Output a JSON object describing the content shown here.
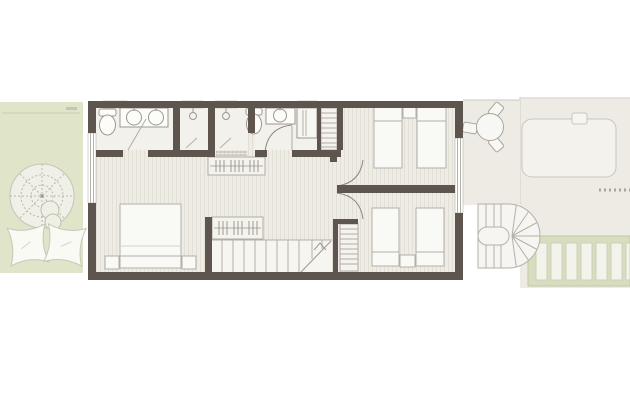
{
  "scene": {
    "type": "architectural-floor-plan",
    "description": "top-view plan of a narrow townhouse upper floor with garden at left, bedrooms and bathrooms inside, terrace, day-bed pad, pergola and exterior curved stair at right",
    "canvas_px": {
      "width": 630,
      "height": 401
    },
    "background": "#ffffff",
    "visible_text": []
  },
  "palette": {
    "wall": "#5e564e",
    "floor_base": "#eeece5",
    "floor_stripe": "#e2dfd7",
    "wet_room_floor": "#f2f1eb",
    "stair_floor": "#f6f5f0",
    "fixture_fill": "#fcfcf9",
    "outline_strong": "#9d988f",
    "outline_light": "#b5b1a8",
    "garden_green": "#e0e4c9",
    "garden_line": "#c9ceb2",
    "terrace_beige": "#edebe4",
    "pool_pad": "#f3f2ed",
    "pergola_green": "#d8ddc0",
    "pergola_slat": "#f3f3ec",
    "dash_marker": "#a8a49b"
  },
  "regions": {
    "garden": {
      "side": "left",
      "items": [
        "parasol",
        "bean-bag-cushion",
        "bean-bag-cushion",
        "side-table",
        "hedge-line"
      ]
    },
    "dwelling": {
      "rooms": [
        {
          "name": "bathroom-1",
          "fixtures": [
            "toilet",
            "double-basin-vanity"
          ]
        },
        {
          "name": "shower-stall-1",
          "fixtures": [
            "shower-head"
          ]
        },
        {
          "name": "shower-stall-2",
          "fixtures": [
            "shower-head"
          ]
        },
        {
          "name": "bathroom-2",
          "fixtures": [
            "toilet",
            "basin-vanity",
            "shower-cabin"
          ]
        },
        {
          "name": "linen-closet",
          "fixtures": [
            "shelf-unit"
          ]
        },
        {
          "name": "master-bedroom",
          "furniture": [
            "double-bed",
            "nightstand",
            "nightstand",
            "hanging-wardrobe"
          ]
        },
        {
          "name": "hallway",
          "furniture": [
            "hanging-wardrobe"
          ],
          "doors": 4
        },
        {
          "name": "bedroom-2",
          "furniture": [
            "single-bed",
            "single-bed",
            "nightstand"
          ]
        },
        {
          "name": "bedroom-3",
          "furniture": [
            "single-bed",
            "single-bed",
            "nightstand",
            "shelf-closet"
          ]
        },
        {
          "name": "staircase",
          "detail": "straight run with diagonal break line and up-chevron"
        }
      ],
      "windows": [
        "top-wall-x4",
        "left-wall-x1",
        "right-wall-glazing-x1"
      ]
    },
    "terrace": {
      "side": "right-of-building",
      "items": [
        "round-table",
        "chair",
        "chair",
        "chair"
      ]
    },
    "roof_terrace": {
      "items": [
        "day-bed-pad",
        "small-step",
        "dashed-marker"
      ]
    },
    "pergola": {
      "slat_count": 7
    },
    "exterior_stair": {
      "shape": "u-turn-curved-stair",
      "treads": "radial+straight"
    }
  }
}
